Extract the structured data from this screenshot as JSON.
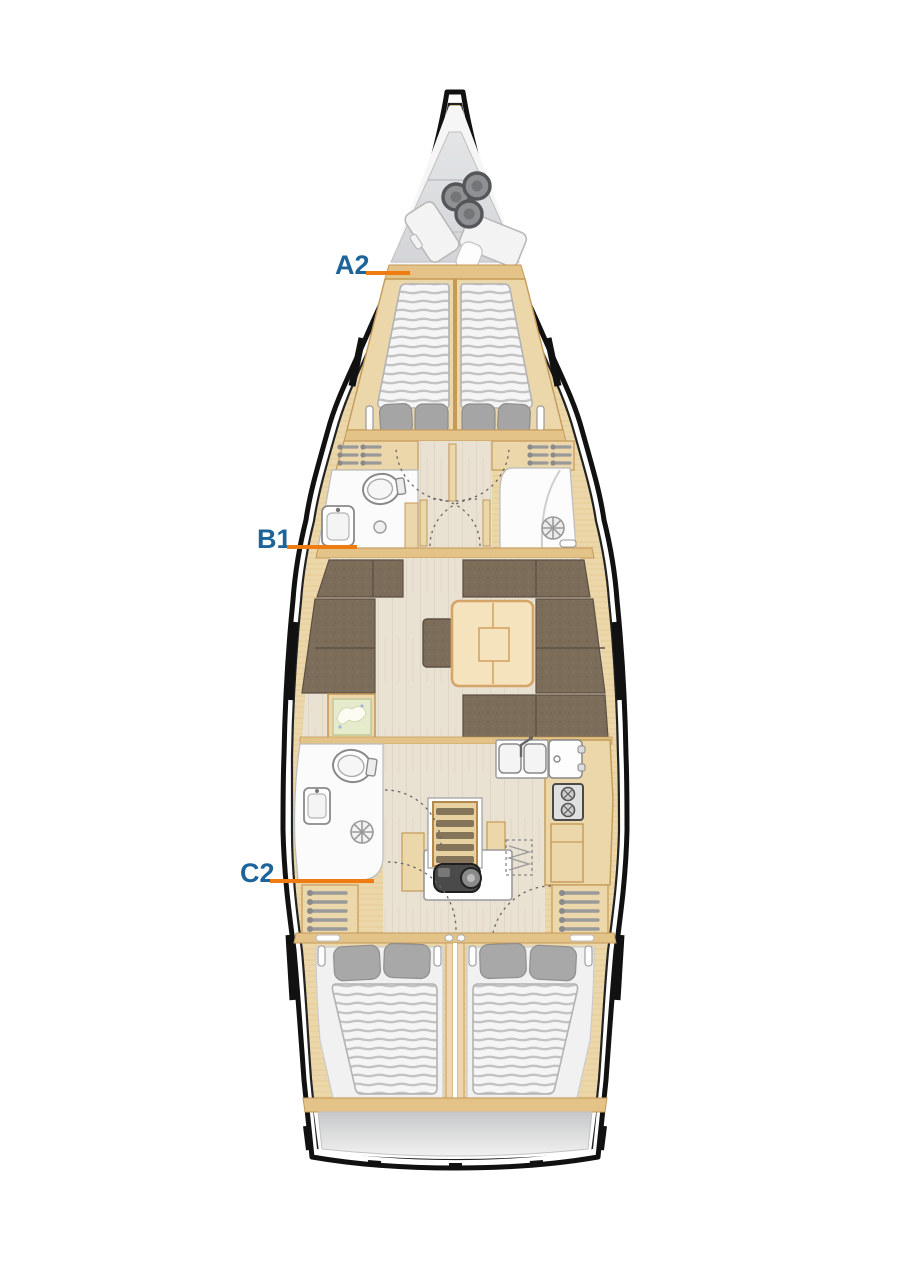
{
  "diagram": {
    "type": "sailing-yacht-interior-layout-plan",
    "background": "#ffffff",
    "labels": [
      {
        "id": "A2",
        "text": "A2"
      },
      {
        "id": "B1",
        "text": "B1"
      },
      {
        "id": "C2",
        "text": "C2"
      }
    ],
    "colors": {
      "label_text": "#1d649b",
      "label_line": "#ee7c12",
      "hull_outline": "#111111",
      "wood": "#ecd7ab",
      "wood_trim": "#c49a58",
      "bulkhead": "#e4c389",
      "floor": "#e9e1d2",
      "upholstery": "#7c6d5b",
      "upholstery_seam": "#5d5143",
      "mattress": "#f5f5f5",
      "mattress_stripe": "#c3c3c3",
      "pillow": "#a8a8a8",
      "deck_gray": "#dadbdd",
      "fixture_white": "#fbfbfb",
      "engine_dark": "#4a4a4a"
    },
    "areas": [
      "anchor-locker",
      "forward-cabin",
      "forward-head",
      "forward-shower",
      "saloon",
      "chart-table",
      "galley",
      "aft-head",
      "companionway",
      "engine-room",
      "aft-cabin-port",
      "aft-cabin-starboard",
      "transom"
    ]
  }
}
